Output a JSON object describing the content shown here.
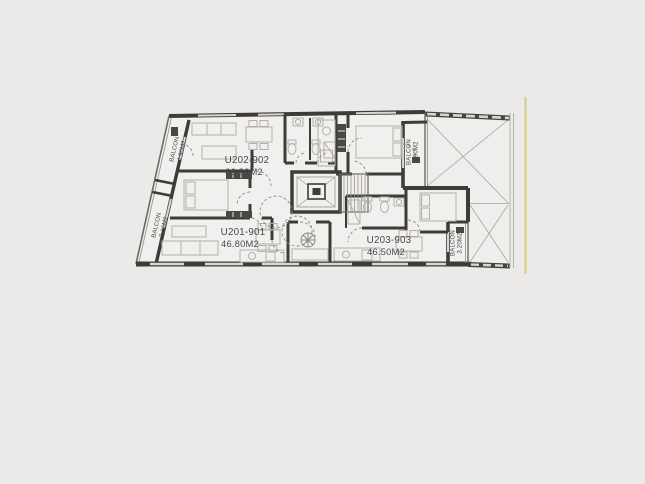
{
  "plan": {
    "units": {
      "u202": {
        "id": "U202-902",
        "area": "66.80M2"
      },
      "u201": {
        "id": "U201-901",
        "area": "46.80M2"
      },
      "u203": {
        "id": "U203-903",
        "area": "46.50M2"
      }
    },
    "balconies": {
      "top_left": {
        "label": "BALCON",
        "area": "4.90M2"
      },
      "bottom_left": {
        "label": "BALCON",
        "area": "7.16M2"
      },
      "top_right": {
        "label": "BALCON",
        "area": "3.90M2"
      },
      "bottom_right": {
        "label": "BALCON",
        "area": "3.20M2"
      }
    }
  },
  "colors": {
    "background": "#ECEAE8",
    "floor": "#F1F0EE",
    "wall": "#3E3C39",
    "furniture_outline": "#B2AFAB",
    "property_line": "#D5CD7D",
    "label_text": "#4A4A4A"
  }
}
